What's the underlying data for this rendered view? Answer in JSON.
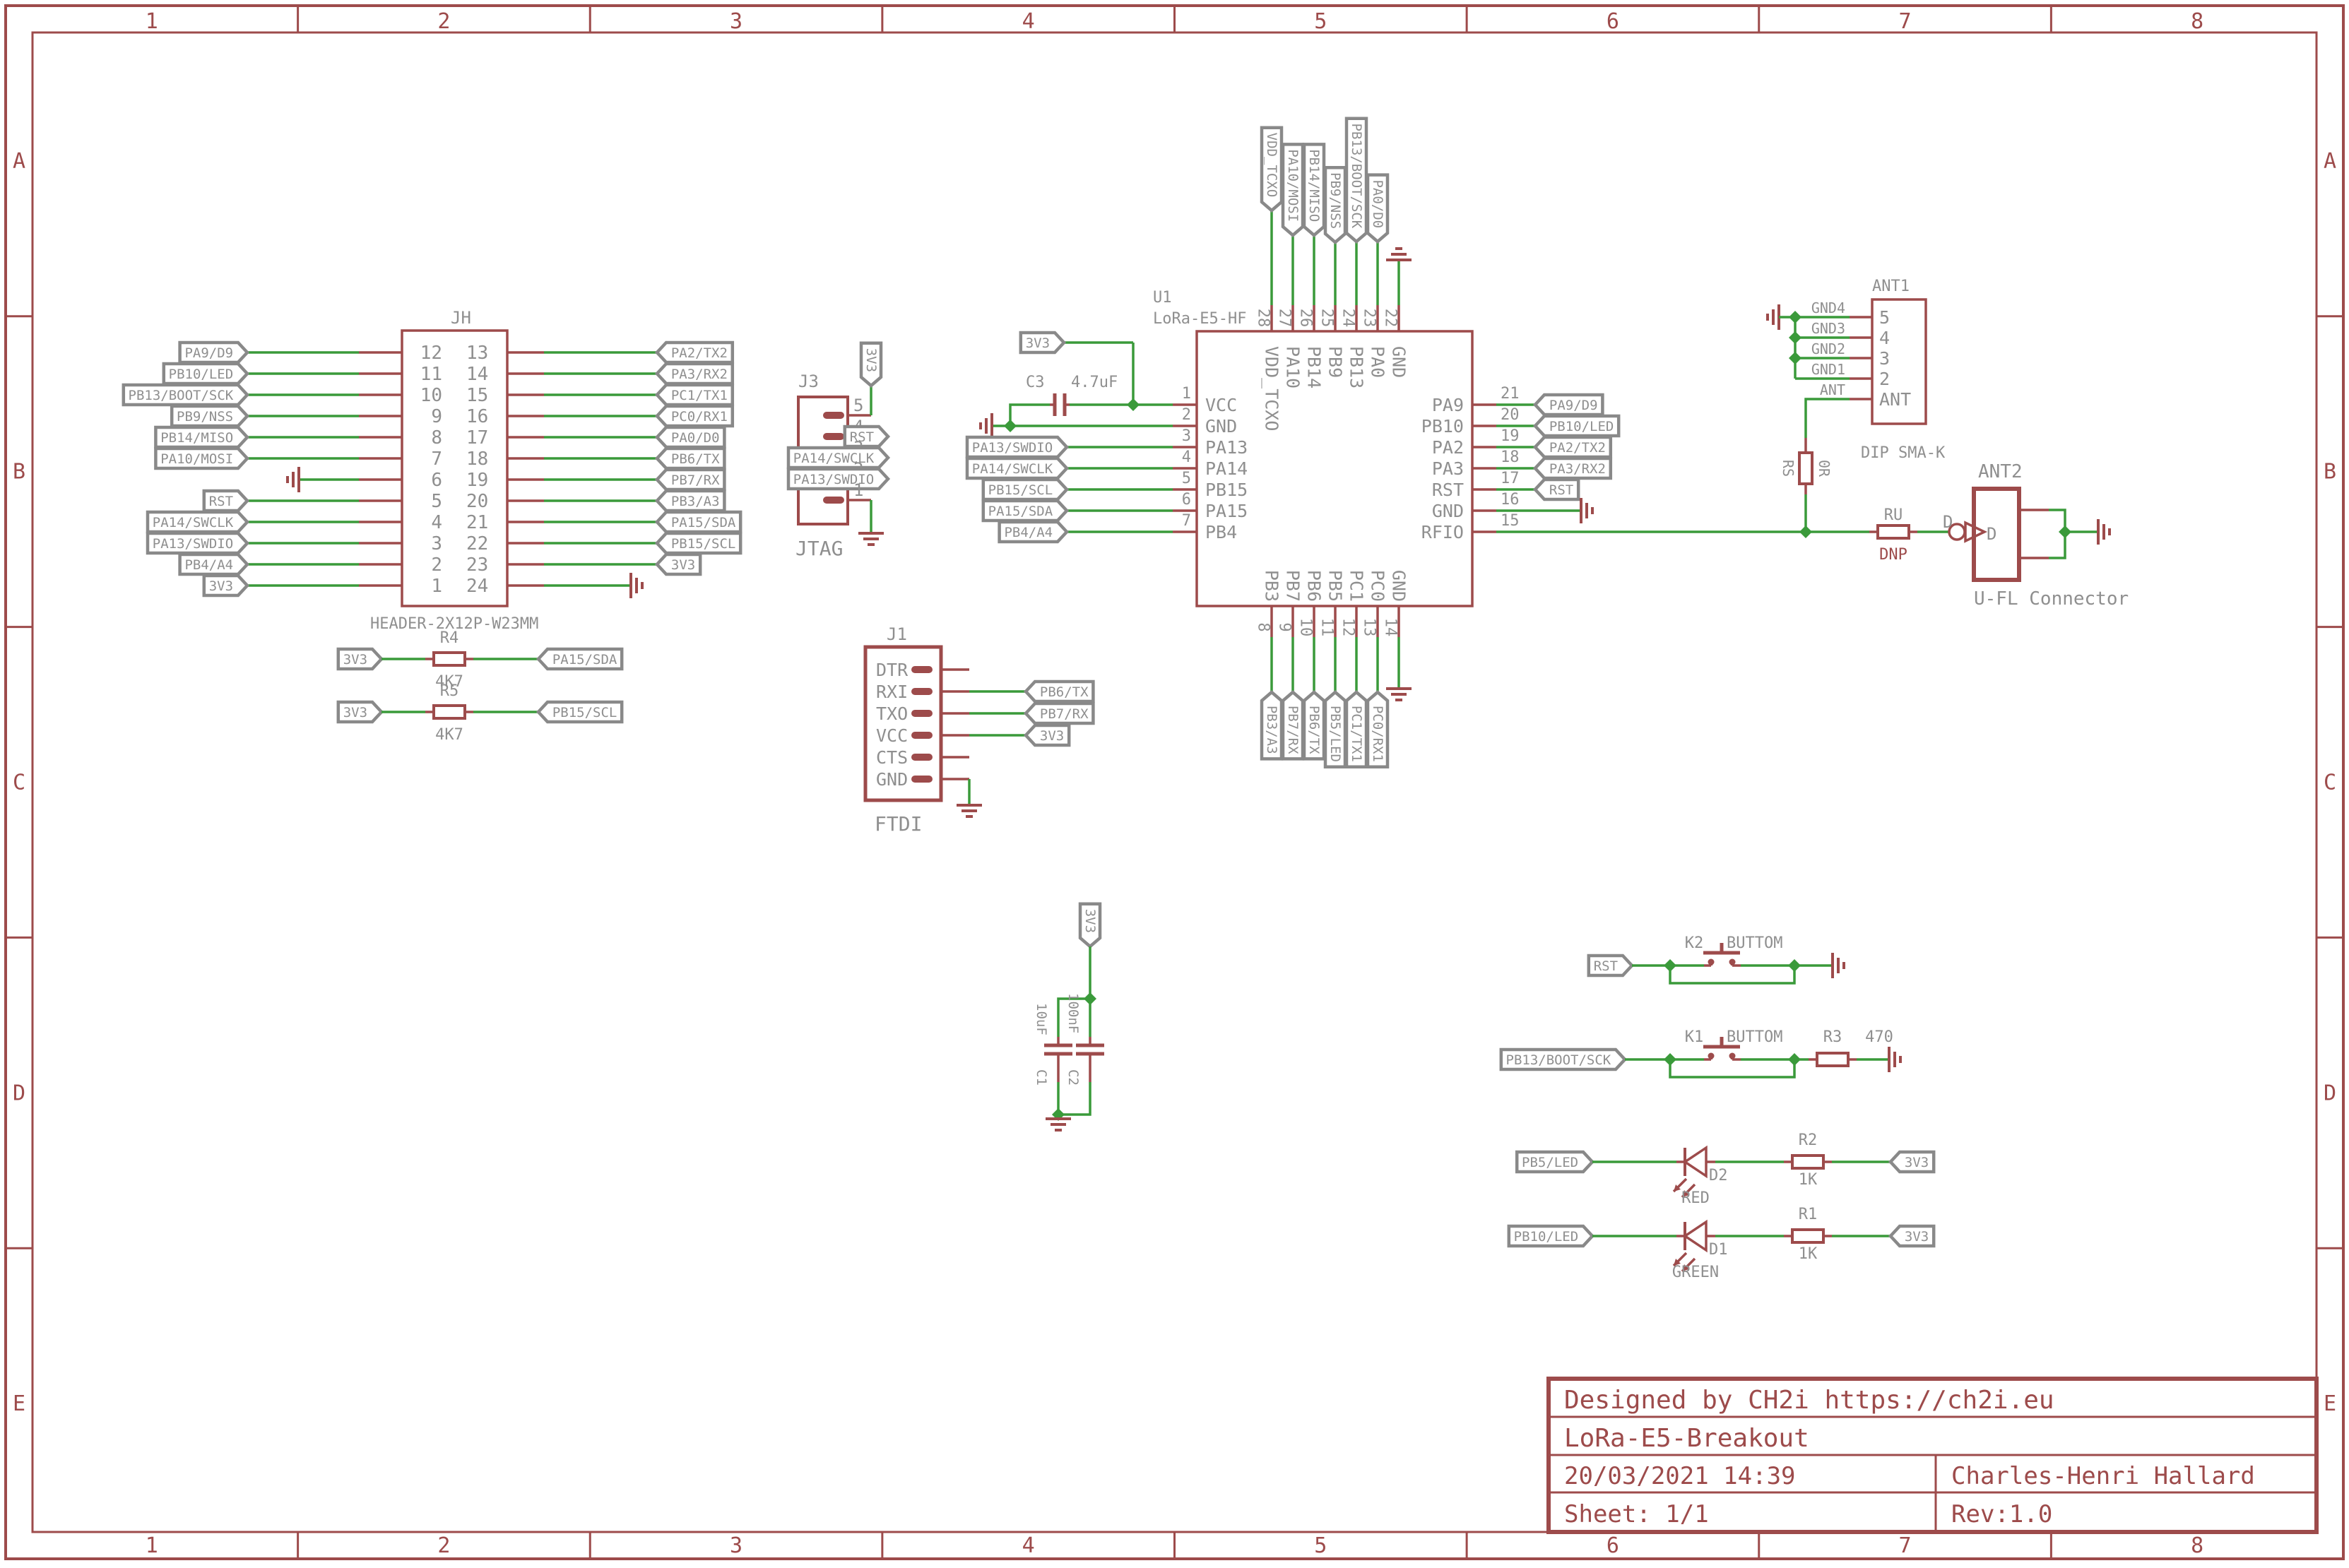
{
  "colors": {
    "wire": "#3a9a3a",
    "component": "#9d4b4b",
    "label": "#8f8f8f",
    "flag_border": "#898989",
    "background": "#ffffff"
  },
  "sheet": {
    "columns": [
      "1",
      "2",
      "3",
      "4",
      "5",
      "6",
      "7",
      "8"
    ],
    "rows": [
      "A",
      "B",
      "C",
      "D",
      "E"
    ]
  },
  "title_block": {
    "designed_by": "Designed by CH2i https://ch2i.eu",
    "title": "LoRa-E5-Breakout",
    "date": "20/03/2021 14:39",
    "author": "Charles-Henri Hallard",
    "sheet": "Sheet: 1/1",
    "rev": "Rev:1.0"
  },
  "jh": {
    "ref": "JH",
    "value": "HEADER-2X12P-W23MM",
    "rows": [
      {
        "left_pin": "12",
        "left_net": "PA9/D9",
        "right_pin": "13",
        "right_net": "PA2/TX2"
      },
      {
        "left_pin": "11",
        "left_net": "PB10/LED",
        "right_pin": "14",
        "right_net": "PA3/RX2"
      },
      {
        "left_pin": "10",
        "left_net": "PB13/BOOT/SCK",
        "right_pin": "15",
        "right_net": "PC1/TX1"
      },
      {
        "left_pin": "9",
        "left_net": "PB9/NSS",
        "right_pin": "16",
        "right_net": "PC0/RX1"
      },
      {
        "left_pin": "8",
        "left_net": "PB14/MISO",
        "right_pin": "17",
        "right_net": "PA0/D0"
      },
      {
        "left_pin": "7",
        "left_net": "PA10/MOSI",
        "right_pin": "18",
        "right_net": "PB6/TX"
      },
      {
        "left_pin": "6",
        "left_net": "GND",
        "left_gnd": true,
        "right_pin": "19",
        "right_net": "PB7/RX"
      },
      {
        "left_pin": "5",
        "left_net": "RST",
        "right_pin": "20",
        "right_net": "PB3/A3"
      },
      {
        "left_pin": "4",
        "left_net": "PA14/SWCLK",
        "right_pin": "21",
        "right_net": "PA15/SDA"
      },
      {
        "left_pin": "3",
        "left_net": "PA13/SWDIO",
        "right_pin": "22",
        "right_net": "PB15/SCL"
      },
      {
        "left_pin": "2",
        "left_net": "PB4/A4",
        "right_pin": "23",
        "right_net": "3V3"
      },
      {
        "left_pin": "1",
        "left_net": "3V3",
        "right_pin": "24",
        "right_net": "GND",
        "right_gnd": true
      }
    ]
  },
  "j3": {
    "ref": "J3",
    "value": "JTAG",
    "pins": [
      {
        "num": "5",
        "net": "3V3",
        "power": true
      },
      {
        "num": "4",
        "net": "RST"
      },
      {
        "num": "3",
        "net": "PA14/SWCLK"
      },
      {
        "num": "2",
        "net": "PA13/SWDIO"
      },
      {
        "num": "1",
        "net": "GND",
        "gnd": true
      }
    ]
  },
  "c3": {
    "ref": "C3",
    "value": "4.7uF",
    "power_net": "3V3"
  },
  "u1": {
    "ref": "U1",
    "value": "LoRa-E5-HF",
    "left_pins": [
      {
        "num": "1",
        "name": "VCC"
      },
      {
        "num": "2",
        "name": "GND",
        "gnd": true
      },
      {
        "num": "3",
        "name": "PA13",
        "net": "PA13/SWDIO"
      },
      {
        "num": "4",
        "name": "PA14",
        "net": "PA14/SWCLK"
      },
      {
        "num": "5",
        "name": "PB15",
        "net": "PB15/SCL"
      },
      {
        "num": "6",
        "name": "PA15",
        "net": "PA15/SDA"
      },
      {
        "num": "7",
        "name": "PB4",
        "net": "PB4/A4"
      }
    ],
    "right_pins": [
      {
        "num": "21",
        "name": "PA9",
        "net": "PA9/D9"
      },
      {
        "num": "20",
        "name": "PB10",
        "net": "PB10/LED"
      },
      {
        "num": "19",
        "name": "PA2",
        "net": "PA2/TX2"
      },
      {
        "num": "18",
        "name": "PA3",
        "net": "PA3/RX2"
      },
      {
        "num": "17",
        "name": "RST",
        "net": "RST"
      },
      {
        "num": "16",
        "name": "GND",
        "gnd": true
      },
      {
        "num": "15",
        "name": "RFIO",
        "rf": true
      }
    ],
    "top_pins": [
      {
        "num": "28",
        "name": "VDD_TCXO",
        "net": "VDD_TCXO"
      },
      {
        "num": "27",
        "name": "PA10",
        "net": "PA10/MOSI"
      },
      {
        "num": "26",
        "name": "PB14",
        "net": "PB14/MISO"
      },
      {
        "num": "25",
        "name": "PB9",
        "net": "PB9/NSS"
      },
      {
        "num": "24",
        "name": "PB13",
        "net": "PB13/BOOT/SCK"
      },
      {
        "num": "23",
        "name": "PA0",
        "net": "PA0/D0"
      },
      {
        "num": "22",
        "name": "GND",
        "gnd": true
      }
    ],
    "bottom_pins": [
      {
        "num": "8",
        "name": "PB3",
        "net": "PB3/A3"
      },
      {
        "num": "9",
        "name": "PB7",
        "net": "PB7/RX"
      },
      {
        "num": "10",
        "name": "PB6",
        "net": "PB6/TX"
      },
      {
        "num": "11",
        "name": "PB5",
        "net": "PB5/LED"
      },
      {
        "num": "12",
        "name": "PC1",
        "net": "PC1/TX1"
      },
      {
        "num": "13",
        "name": "PC0",
        "net": "PC0/RX1"
      },
      {
        "num": "14",
        "name": "GND",
        "gnd": true
      }
    ]
  },
  "r4": {
    "ref": "R4",
    "value": "4K7",
    "left_net": "3V3",
    "right_net": "PA15/SDA"
  },
  "r5": {
    "ref": "R5",
    "value": "4K7",
    "left_net": "3V3",
    "right_net": "PB15/SCL"
  },
  "j1": {
    "ref": "J1",
    "value": "FTDI",
    "pins": [
      {
        "name": "DTR"
      },
      {
        "name": "RXI",
        "net": "PB6/TX"
      },
      {
        "name": "TXO",
        "net": "PB7/RX"
      },
      {
        "name": "VCC",
        "net": "3V3",
        "power": true
      },
      {
        "name": "CTS"
      },
      {
        "name": "GND",
        "gnd": true
      }
    ]
  },
  "c1": {
    "ref": "C1",
    "value": "10uF"
  },
  "c2": {
    "ref": "C2",
    "value": "100nF"
  },
  "cap_power_net": "3V3",
  "ant1": {
    "ref": "ANT1",
    "value": "DIP SMA-K",
    "pins": [
      {
        "name": "5",
        "net": "GND4"
      },
      {
        "name": "4",
        "net": "GND3"
      },
      {
        "name": "3",
        "net": "GND2"
      },
      {
        "name": "2",
        "net": "GND1"
      },
      {
        "name": "ANT",
        "net": "ANT"
      }
    ]
  },
  "rs": {
    "ref": "RS",
    "value": "0R"
  },
  "ru": {
    "ref": "RU",
    "value": "DNP"
  },
  "ant2": {
    "ref": "ANT2",
    "value": "U-FL Connector",
    "pin_label": "D",
    "pin_name": "D"
  },
  "k2": {
    "ref": "K2",
    "value": "BUTTOM",
    "net": "RST"
  },
  "k1": {
    "ref": "K1",
    "value": "BUTTOM",
    "net": "PB13/BOOT/SCK"
  },
  "r3": {
    "ref": "R3",
    "value": "470"
  },
  "d2": {
    "ref": "D2",
    "value": "RED",
    "net": "PB5/LED",
    "res_ref": "R2",
    "res_value": "1K",
    "power": "3V3"
  },
  "d1": {
    "ref": "D1",
    "value": "GREEN",
    "net": "PB10/LED",
    "res_ref": "R1",
    "res_value": "1K",
    "power": "3V3"
  }
}
